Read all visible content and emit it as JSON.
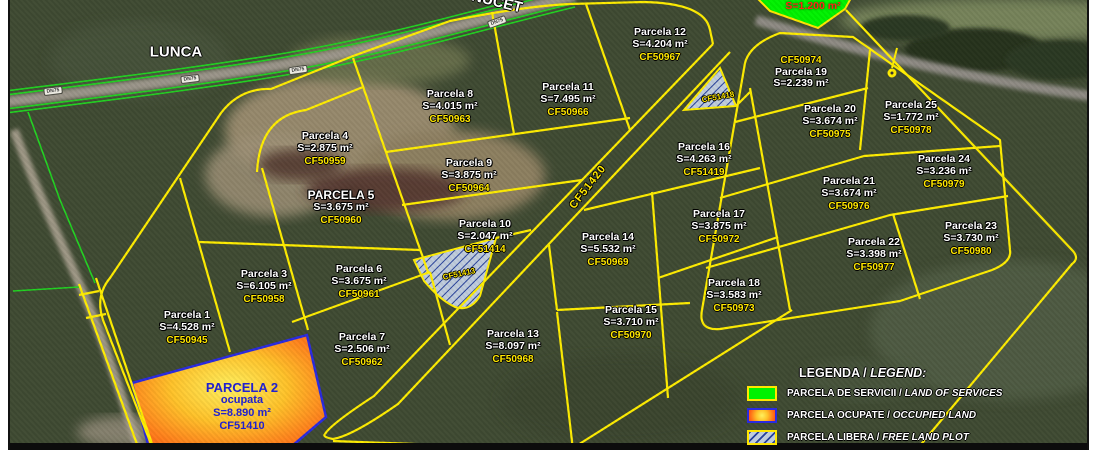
{
  "map": {
    "place_labels": {
      "lunca": "LUNCA",
      "nucet": "NUCET"
    },
    "road_sign": "DN75",
    "road_parcel_ref": "CF51420",
    "parcels": [
      {
        "name": "Parcela 1",
        "area": "S=4.528 m²",
        "cf": "CF50945",
        "x": 177,
        "y": 328
      },
      {
        "name": "Parcela 3",
        "area": "S=6.105 m²",
        "cf": "CF50958",
        "x": 254,
        "y": 287
      },
      {
        "name": "Parcela 4",
        "area": "S=2.875 m²",
        "cf": "CF50959",
        "x": 315,
        "y": 149
      },
      {
        "name": "PARCELA 5",
        "area": "S=3.675 m²",
        "cf": "CF50960",
        "x": 331,
        "y": 208,
        "variant": "caps"
      },
      {
        "name": "Parcela 6",
        "area": "S=3.675 m²",
        "cf": "CF50961",
        "x": 349,
        "y": 282
      },
      {
        "name": "Parcela 7",
        "area": "S=2.506 m²",
        "cf": "CF50962",
        "x": 352,
        "y": 350
      },
      {
        "name": "Parcela 8",
        "area": "S=4.015 m²",
        "cf": "CF50963",
        "x": 440,
        "y": 107
      },
      {
        "name": "Parcela 9",
        "area": "S=3.875 m²",
        "cf": "CF50964",
        "x": 459,
        "y": 176
      },
      {
        "name": "Parcela 10",
        "area": "S=2.047 m²",
        "cf": "CF51414",
        "x": 475,
        "y": 237
      },
      {
        "name": "Parcela 11",
        "area": "S=7.495 m²",
        "cf": "CF50966",
        "x": 558,
        "y": 100
      },
      {
        "name": "Parcela 12",
        "area": "S=4.204 m²",
        "cf": "CF50967",
        "x": 650,
        "y": 45
      },
      {
        "name": "Parcela 13",
        "area": "S=8.097 m²",
        "cf": "CF50968",
        "x": 503,
        "y": 347
      },
      {
        "name": "Parcela 14",
        "area": "S=5.532 m²",
        "cf": "CF50969",
        "x": 598,
        "y": 250
      },
      {
        "name": "Parcela 15",
        "area": "S=3.710 m²",
        "cf": "CF50970",
        "x": 621,
        "y": 323
      },
      {
        "name": "Parcela 16",
        "area": "S=4.263 m²",
        "cf": "CF51419",
        "x": 694,
        "y": 160
      },
      {
        "name": "Parcela 17",
        "area": "S=3.875 m²",
        "cf": "CF50972",
        "x": 709,
        "y": 227
      },
      {
        "name": "Parcela 18",
        "area": "S=3.583 m²",
        "cf": "CF50973",
        "x": 724,
        "y": 296
      },
      {
        "name": "Parcela 19",
        "area": "S=2.239 m²",
        "cf": "CF50974",
        "x": 791,
        "y": 71,
        "cf_position": "top"
      },
      {
        "name": "Parcela 20",
        "area": "S=3.674 m²",
        "cf": "CF50975",
        "x": 820,
        "y": 122
      },
      {
        "name": "Parcela 21",
        "area": "S=3.674 m²",
        "cf": "CF50976",
        "x": 839,
        "y": 194
      },
      {
        "name": "Parcela 22",
        "area": "S=3.398 m²",
        "cf": "CF50977",
        "x": 864,
        "y": 255
      },
      {
        "name": "Parcela 23",
        "area": "S=3.730 m²",
        "cf": "CF50980",
        "x": 961,
        "y": 239
      },
      {
        "name": "Parcela 24",
        "area": "S=3.236 m²",
        "cf": "CF50979",
        "x": 934,
        "y": 172
      },
      {
        "name": "Parcela 25",
        "area": "S=1.772 m²",
        "cf": "CF50978",
        "x": 901,
        "y": 118
      }
    ],
    "occupied_parcel": {
      "name": "PARCELA 2",
      "status": "ocupata",
      "area": "S=8.890 m²",
      "cf": "CF51410",
      "x": 232,
      "y": 383
    },
    "service_parcel": {
      "area": "S=1.200 m²",
      "x": 803,
      "y": 0
    },
    "free_plots": [
      {
        "cf": "CF51413",
        "x": 449,
        "y": 274,
        "rotate": -12
      },
      {
        "cf": "CF51418",
        "x": 708,
        "y": 97,
        "rotate": -10
      }
    ],
    "road_sign_positions": [
      {
        "x": 43,
        "y": 91,
        "r": -7
      },
      {
        "x": 180,
        "y": 79,
        "r": -7
      },
      {
        "x": 288,
        "y": 70,
        "r": -8
      },
      {
        "x": 487,
        "y": 22,
        "r": -20
      }
    ],
    "colors": {
      "parcel_line": "#ffed00",
      "boundary_green": "#21d321",
      "cf_text": "#ffe800",
      "occupied_border": "#2a2ae0",
      "occupied_text": "#2121cf",
      "service_fill": "#00f200",
      "service_text": "#ff2516"
    }
  },
  "legend": {
    "title_ro": "LEGENDA / ",
    "title_en": "LEGEND:",
    "items": [
      {
        "swatch": "services",
        "label_ro": "PARCELA DE SERVICII / ",
        "label_en": "LAND OF SERVICES"
      },
      {
        "swatch": "occupied",
        "label_ro": "PARCELA OCUPATE / ",
        "label_en": "OCCUPIED LAND"
      },
      {
        "swatch": "free",
        "label_ro": "PARCELA LIBERA / ",
        "label_en": "FREE LAND PLOT"
      }
    ]
  }
}
